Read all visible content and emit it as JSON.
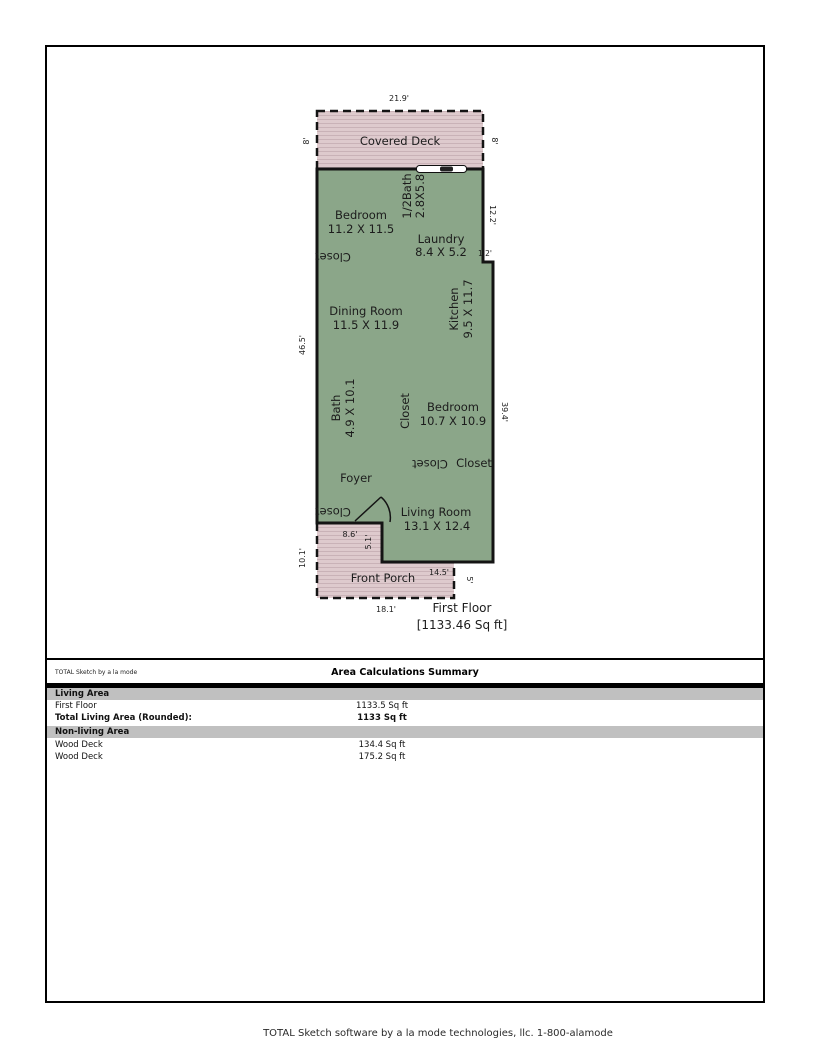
{
  "plan": {
    "colors": {
      "living_fill": "#8ba689",
      "deck_fill": "#decacd",
      "deck_stripe": "#c9b2b7",
      "wall": "#141414"
    },
    "closet_label": "Closet",
    "rooms": {
      "covered_deck": {
        "name": "Covered Deck"
      },
      "bedroom1": {
        "name": "Bedroom",
        "dims": "11.2 X 11.5"
      },
      "half_bath": {
        "name": "1/2Bath",
        "dims": "2.8X5.8"
      },
      "laundry": {
        "name": "Laundry",
        "dims": "8.4 X 5.2"
      },
      "dining": {
        "name": "Dining Room",
        "dims": "11.5 X 11.9"
      },
      "kitchen": {
        "name": "Kitchen",
        "dims": "9.5 X 11.7"
      },
      "bath": {
        "name": "Bath",
        "dims": "4.9 X 10.1"
      },
      "bedroom2": {
        "name": "Bedroom",
        "dims": "10.7 X 10.9"
      },
      "living": {
        "name": "Living Room",
        "dims": "13.1 X 12.4"
      },
      "foyer": {
        "name": "Foyer"
      },
      "front_porch": {
        "name": "Front Porch"
      }
    },
    "dims": {
      "deck_width": "21.9'",
      "deck_left": "8'",
      "deck_right": "8'",
      "right_upper": "12.2'",
      "step": "1.2'",
      "left_side": "46.5'",
      "right_lower": "39.4'",
      "porch_top": "8.6'",
      "porch_step": "5.1'",
      "porch_left": "10.1'",
      "bottom_inner": "14.5'",
      "porch_right": "5'",
      "porch_bottom": "18.1'"
    },
    "floor_title": "First Floor",
    "floor_area": "[1133.46 Sq ft]"
  },
  "title_block": {
    "left_label": "TOTAL Sketch by a la mode",
    "center_label": "Area Calculations Summary"
  },
  "summary": {
    "sections": [
      {
        "header": "Living Area",
        "rows": [
          {
            "label": "First Floor",
            "value": "1133.5 Sq ft"
          },
          {
            "label": "Total Living Area (Rounded):",
            "value": "1133 Sq ft"
          }
        ]
      },
      {
        "header": "Non-living Area",
        "rows": [
          {
            "label": "Wood Deck",
            "value": "134.4 Sq ft"
          },
          {
            "label": "Wood Deck",
            "value": "175.2 Sq ft"
          }
        ]
      }
    ]
  },
  "footer": "TOTAL Sketch software by a la mode technologies, llc. 1-800-alamode"
}
